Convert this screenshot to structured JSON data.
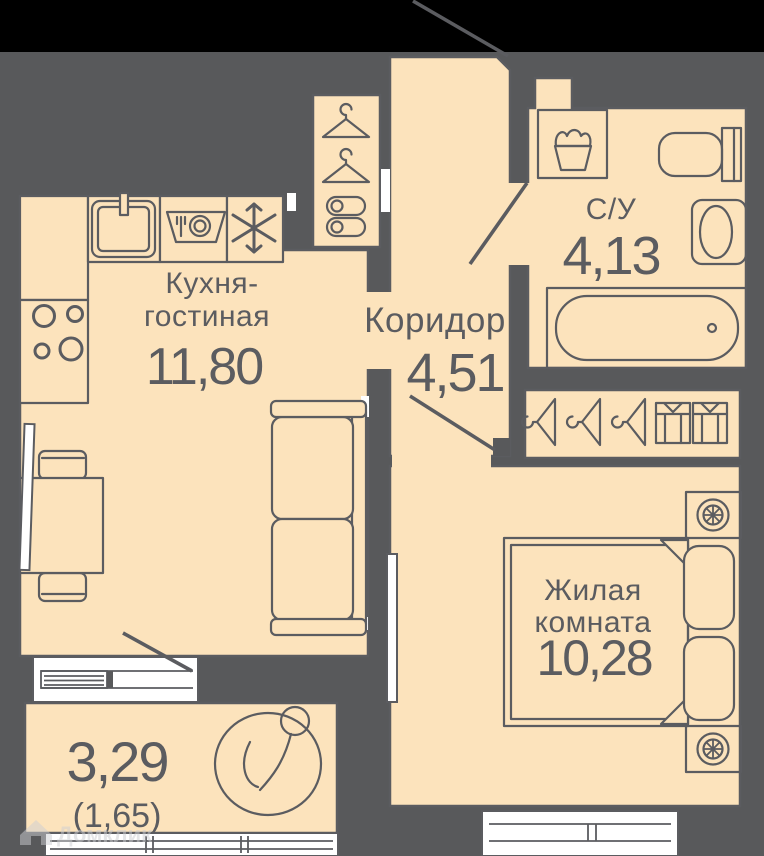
{
  "colors": {
    "background": "#58595B",
    "top_band": "#000000",
    "room_fill": "#FCE3BC",
    "line": "#5B5C60",
    "window_white": "#FFFFFF"
  },
  "rooms": {
    "kitchen": {
      "name1": "Кухня-",
      "name2": "гостиная",
      "area": "11,80"
    },
    "corridor": {
      "name": "Коридор",
      "area": "4,51"
    },
    "bathroom": {
      "name": "С/У",
      "area": "4,13"
    },
    "living": {
      "name1": "Жилая",
      "name2": "комната",
      "area": "10,28"
    },
    "balcony": {
      "area": "3,29",
      "area_secondary": "(1,65)"
    }
  },
  "icons": {
    "kitchen": [
      "sink",
      "dishwasher",
      "fridge-snowflake",
      "stove-burners",
      "sofa",
      "table",
      "chairs",
      "tv"
    ],
    "hallway_closet": [
      "hanger",
      "hanger",
      "slippers"
    ],
    "bathroom": [
      "washing-machine",
      "toilet",
      "washbasin",
      "bathtub"
    ],
    "wardrobe": [
      "hanger",
      "hanger",
      "hanger",
      "folded-shirt",
      "folded-shirt"
    ],
    "living": [
      "bed",
      "pillows",
      "nightstand-lamp",
      "nightstand-lamp",
      "tv"
    ],
    "balcony": [
      "plant"
    ]
  },
  "watermark": {
    "brand": "Домклик"
  }
}
